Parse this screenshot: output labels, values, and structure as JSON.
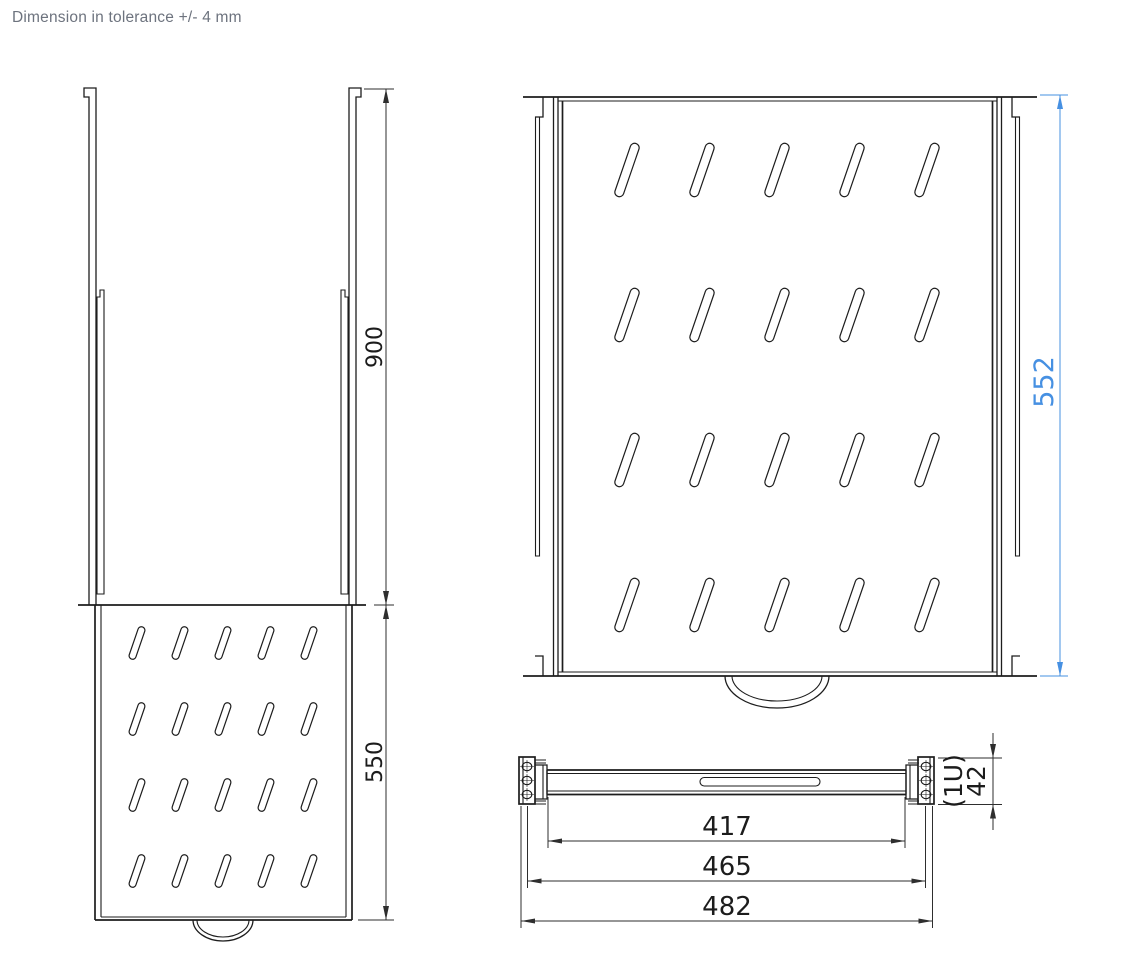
{
  "title": "Dimension in tolerance +/- 4 mm",
  "colors": {
    "line": "#1d1d1d",
    "dimension": "#2e2e2e",
    "accent_blue": "#4690e2",
    "title_gray": "#6d737e",
    "background": "#ffffff"
  },
  "dimensions": {
    "rail_length": "900",
    "shelf_depth_side": "550",
    "shelf_depth_top": "552",
    "width_inner": "417",
    "width_mounting": "465",
    "width_overall": "482",
    "height_units": "(1U)",
    "height": "42"
  }
}
